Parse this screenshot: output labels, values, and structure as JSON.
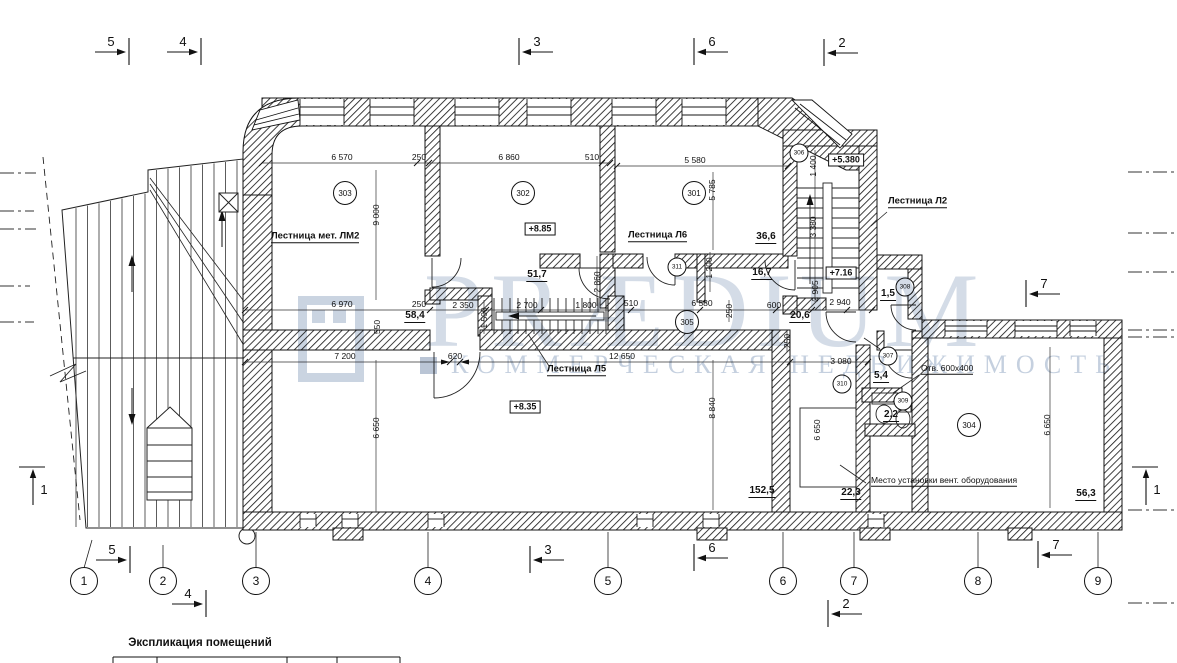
{
  "watermark": {
    "brand": "PRÆDIUM",
    "tagline": "КОММЕРЧЕСКАЯ НЕДВИЖИМОСТЬ"
  },
  "explication_title": "Экспликация помещений",
  "grid_bubbles": [
    {
      "n": "1",
      "x": 84
    },
    {
      "n": "2",
      "x": 163
    },
    {
      "n": "3",
      "x": 256
    },
    {
      "n": "4",
      "x": 428
    },
    {
      "n": "5",
      "x": 608
    },
    {
      "n": "6",
      "x": 783
    },
    {
      "n": "7",
      "x": 854
    },
    {
      "n": "8",
      "x": 978
    },
    {
      "n": "9",
      "x": 1098
    }
  ],
  "section_markers": [
    {
      "n": "5",
      "x": 111,
      "y": 42,
      "dir": "right"
    },
    {
      "n": "4",
      "x": 183,
      "y": 42,
      "dir": "right"
    },
    {
      "n": "3",
      "x": 537,
      "y": 42,
      "dir": "left"
    },
    {
      "n": "6",
      "x": 712,
      "y": 42,
      "dir": "left"
    },
    {
      "n": "2",
      "x": 842,
      "y": 43,
      "dir": "left"
    },
    {
      "n": "7",
      "x": 1044,
      "y": 284,
      "dir": "left"
    },
    {
      "n": "5",
      "x": 112,
      "y": 550,
      "dir": "right"
    },
    {
      "n": "4",
      "x": 188,
      "y": 594,
      "dir": "right"
    },
    {
      "n": "3",
      "x": 548,
      "y": 550,
      "dir": "left"
    },
    {
      "n": "6",
      "x": 712,
      "y": 548,
      "dir": "left"
    },
    {
      "n": "2",
      "x": 846,
      "y": 604,
      "dir": "left"
    },
    {
      "n": "7",
      "x": 1056,
      "y": 545,
      "dir": "left"
    },
    {
      "n": "1",
      "x": 44,
      "y": 490,
      "dir": "up"
    },
    {
      "n": "1",
      "x": 1157,
      "y": 490,
      "dir": "up"
    }
  ],
  "rooms": [
    {
      "num": "303",
      "x": 345,
      "y": 193,
      "big": 1
    },
    {
      "num": "302",
      "x": 523,
      "y": 193,
      "big": 1
    },
    {
      "num": "301",
      "x": 694,
      "y": 193,
      "big": 1
    },
    {
      "num": "305",
      "x": 687,
      "y": 322,
      "big": 1
    },
    {
      "num": "311",
      "x": 677,
      "y": 267,
      "big": 0
    },
    {
      "num": "306",
      "x": 799,
      "y": 153,
      "big": 0
    },
    {
      "num": "308",
      "x": 905,
      "y": 287,
      "big": 0
    },
    {
      "num": "307",
      "x": 888,
      "y": 356,
      "big": 0
    },
    {
      "num": "309",
      "x": 903,
      "y": 401,
      "big": 0
    },
    {
      "num": "310",
      "x": 842,
      "y": 384,
      "big": 0
    },
    {
      "num": "304",
      "x": 969,
      "y": 425,
      "big": 1
    }
  ],
  "areas": [
    {
      "v": "58,4",
      "x": 415,
      "y": 317
    },
    {
      "v": "51,7",
      "x": 537,
      "y": 276
    },
    {
      "v": "36,6",
      "x": 766,
      "y": 238
    },
    {
      "v": "16,7",
      "x": 762,
      "y": 274
    },
    {
      "v": "20,6",
      "x": 800,
      "y": 317
    },
    {
      "v": "1,5",
      "x": 888,
      "y": 295
    },
    {
      "v": "5,4",
      "x": 881,
      "y": 377
    },
    {
      "v": "2,2",
      "x": 891,
      "y": 416
    },
    {
      "v": "22,3",
      "x": 851,
      "y": 494
    },
    {
      "v": "152,5",
      "x": 762,
      "y": 492
    },
    {
      "v": "56,3",
      "x": 1086,
      "y": 495
    }
  ],
  "elevations": [
    {
      "v": "+8.85",
      "x": 540,
      "y": 229
    },
    {
      "v": "+8.35",
      "x": 525,
      "y": 407
    },
    {
      "v": "+5.380",
      "x": 846,
      "y": 160
    },
    {
      "v": "+7.16",
      "x": 841,
      "y": 273
    }
  ],
  "stair_labels": [
    {
      "t": "Лестница мет. ЛМ2",
      "x": 271,
      "y": 237
    },
    {
      "t": "Лестница Л6",
      "x": 628,
      "y": 236
    },
    {
      "t": "Лестница Л5",
      "x": 547,
      "y": 370
    },
    {
      "t": "Лестница Л2",
      "x": 888,
      "y": 202
    }
  ],
  "notes": [
    {
      "t": "Отв. 600x400",
      "x": 921,
      "y": 369
    },
    {
      "t": "Место установки вент. оборудования",
      "x": 871,
      "y": 481
    }
  ],
  "dims_h": [
    {
      "v": "6 570",
      "x": 342,
      "y": 157
    },
    {
      "v": "250",
      "x": 419,
      "y": 157
    },
    {
      "v": "6 860",
      "x": 509,
      "y": 157
    },
    {
      "v": "510",
      "x": 592,
      "y": 157
    },
    {
      "v": "5 580",
      "x": 695,
      "y": 160
    },
    {
      "v": "6 970",
      "x": 342,
      "y": 304
    },
    {
      "v": "250",
      "x": 419,
      "y": 304
    },
    {
      "v": "2 350",
      "x": 463,
      "y": 305
    },
    {
      "v": "2 700",
      "x": 527,
      "y": 305
    },
    {
      "v": "1 800",
      "x": 586,
      "y": 305
    },
    {
      "v": "510",
      "x": 631,
      "y": 303
    },
    {
      "v": "6 580",
      "x": 702,
      "y": 303
    },
    {
      "v": "600",
      "x": 774,
      "y": 305
    },
    {
      "v": "2 940",
      "x": 840,
      "y": 302
    },
    {
      "v": "7 200",
      "x": 345,
      "y": 356
    },
    {
      "v": "620",
      "x": 455,
      "y": 356
    },
    {
      "v": "12 650",
      "x": 622,
      "y": 356
    },
    {
      "v": "3 080",
      "x": 841,
      "y": 361
    }
  ],
  "dims_v": [
    {
      "v": "9 000",
      "x": 376,
      "y": 215
    },
    {
      "v": "5 785",
      "x": 712,
      "y": 190
    },
    {
      "v": "2 860",
      "x": 597,
      "y": 282
    },
    {
      "v": "550",
      "x": 377,
      "y": 327
    },
    {
      "v": "1 500",
      "x": 484,
      "y": 318
    },
    {
      "v": "250",
      "x": 729,
      "y": 311
    },
    {
      "v": "1 200",
      "x": 709,
      "y": 268
    },
    {
      "v": "1 400",
      "x": 813,
      "y": 166
    },
    {
      "v": "3 380",
      "x": 813,
      "y": 227
    },
    {
      "v": "2 905",
      "x": 815,
      "y": 291
    },
    {
      "v": "6 650",
      "x": 376,
      "y": 428
    },
    {
      "v": "8 840",
      "x": 712,
      "y": 408
    },
    {
      "v": "250",
      "x": 787,
      "y": 341
    },
    {
      "v": "6 650",
      "x": 817,
      "y": 430
    },
    {
      "v": "6 650",
      "x": 1047,
      "y": 425
    }
  ]
}
